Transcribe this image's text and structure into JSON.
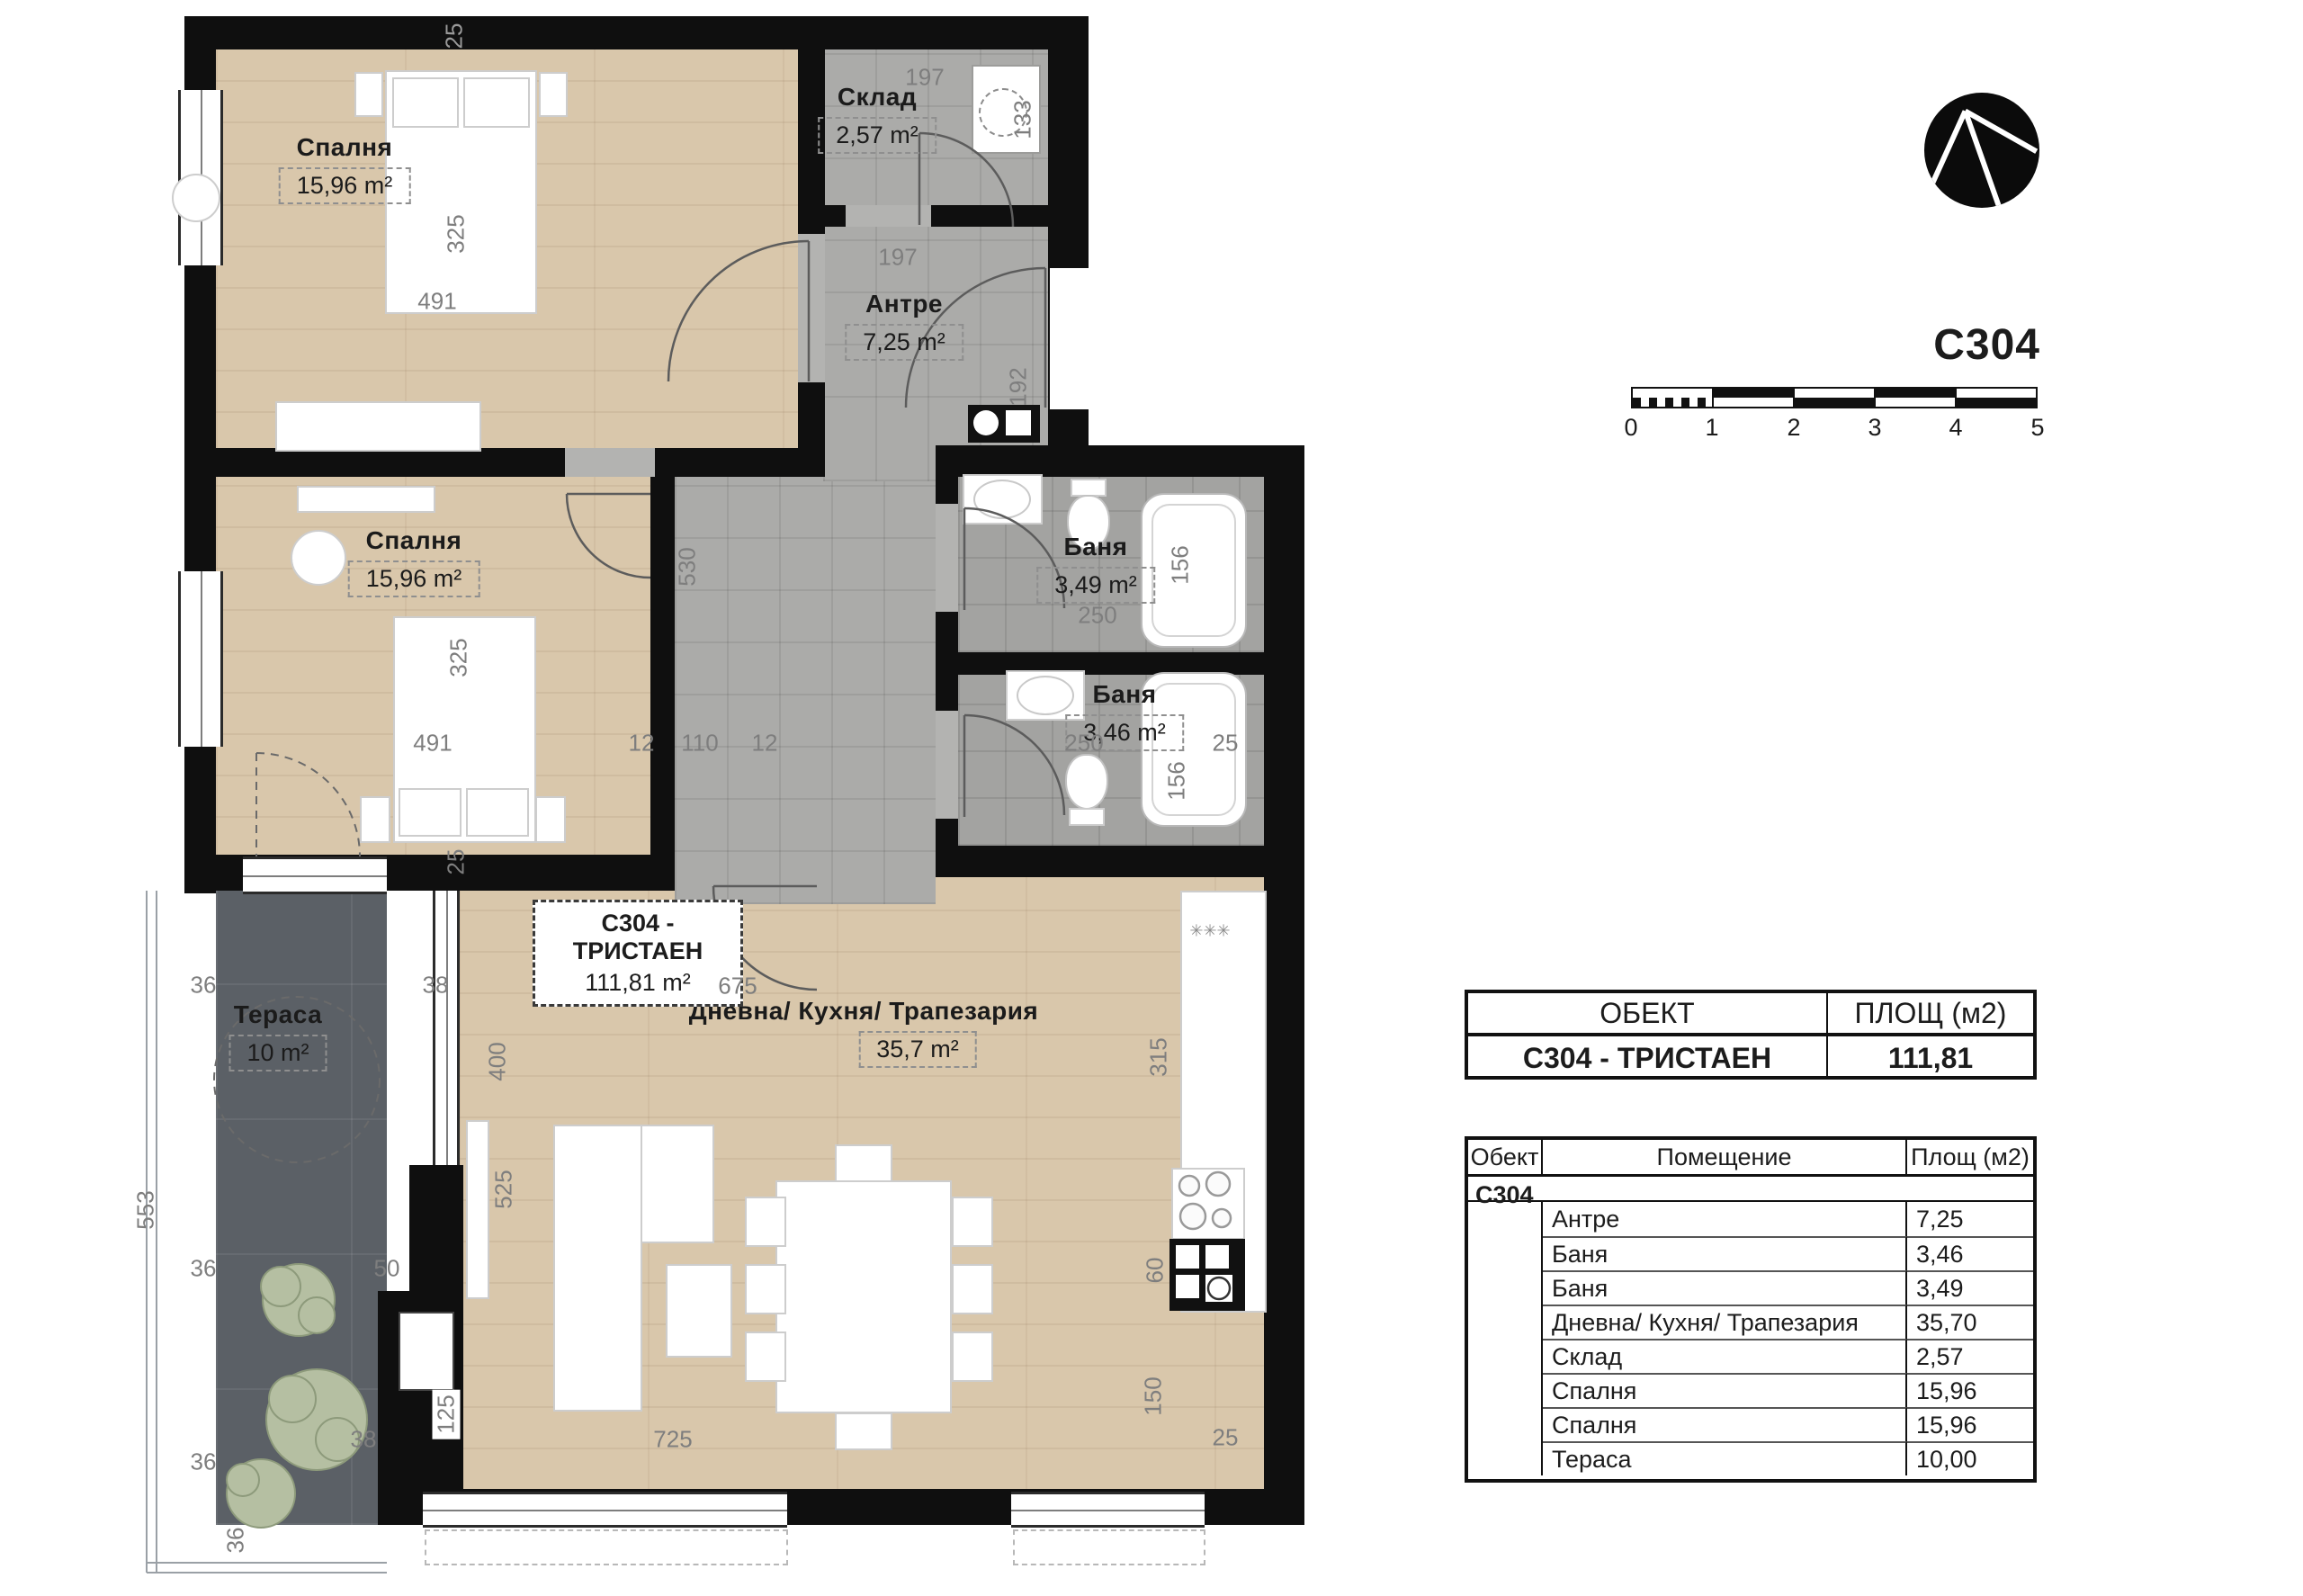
{
  "unit": {
    "code": "C304",
    "box_title": "C304 - ТРИСТАЕН",
    "box_area": "111,81 m²"
  },
  "scale_bar": {
    "labels": [
      "0",
      "1",
      "2",
      "3",
      "4",
      "5"
    ]
  },
  "rooms": {
    "bedroom1": {
      "name": "Спалня",
      "area": "15,96 m²"
    },
    "storage": {
      "name": "Склад",
      "area": "2,57 m²"
    },
    "hall": {
      "name": "Антре",
      "area": "7,25 m²"
    },
    "bath1": {
      "name": "Баня",
      "area": "3,49 m²"
    },
    "bath2": {
      "name": "Баня",
      "area": "3,46 m²"
    },
    "bedroom2": {
      "name": "Спалня",
      "area": "15,96 m²"
    },
    "living": {
      "name": "Дневна/ Кухня/ Трапезария",
      "area": "35,7 m²"
    },
    "terrace": {
      "name": "Тераса",
      "area": "10 m²"
    }
  },
  "dims": {
    "top25": "25",
    "skl197": "197",
    "skl133": "133",
    "ant197": "197",
    "ant192": "192",
    "b1v325": "325",
    "b1h491": "491",
    "b2v325": "325",
    "b2h491": "491",
    "cor530": "530",
    "cor12a": "12",
    "cor110": "110",
    "cor12b": "12",
    "ba1h250": "250",
    "ba1v156": "156",
    "ba2h250": "250",
    "ba2v156": "156",
    "ba2r25": "25",
    "b2b25": "25",
    "lv675": "675",
    "lv400": "400",
    "lv315": "315",
    "lv525": "525",
    "kv60": "60",
    "kv150": "150",
    "k25": "25",
    "lv725": "725",
    "lv125": "125",
    "lv38": "38",
    "t36a": "36",
    "t553": "553",
    "t36b": "36",
    "t38": "38",
    "t50": "50",
    "t36c": "36",
    "t36d": "36"
  },
  "summary_table": {
    "col_object": "ОБЕКТ",
    "col_area": "ПЛОЩ (м2)",
    "row_object": "С304 - ТРИСТАЕН",
    "row_area": "111,81"
  },
  "rooms_table": {
    "col_object": "Обект",
    "col_room": "Помещение",
    "col_area": "Площ (м2)",
    "group": "С304",
    "rows": [
      {
        "room": "Антре",
        "area": "7,25"
      },
      {
        "room": "Баня",
        "area": "3,46"
      },
      {
        "room": "Баня",
        "area": "3,49"
      },
      {
        "room": "Дневна/ Кухня/ Трапезария",
        "area": "35,70"
      },
      {
        "room": "Склад",
        "area": "2,57"
      },
      {
        "room": "Спалня",
        "area": "15,96"
      },
      {
        "room": "Спалня",
        "area": "15,96"
      },
      {
        "room": "Тераса",
        "area": "10,00"
      }
    ]
  }
}
